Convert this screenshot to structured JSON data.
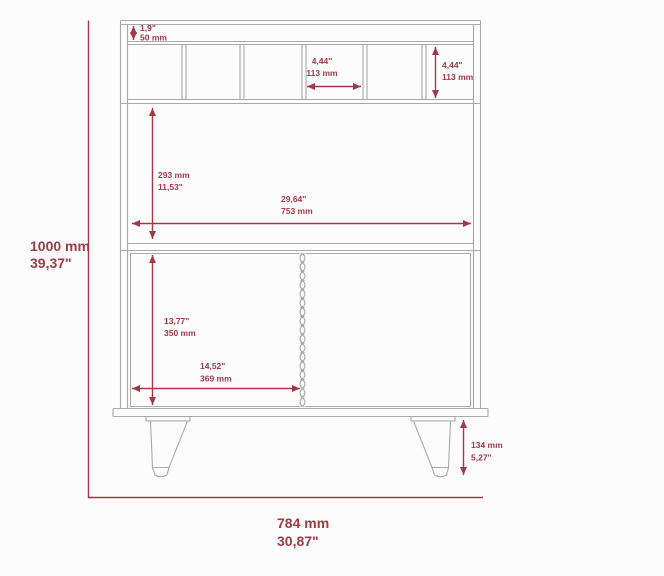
{
  "diagram": {
    "type": "furniture-dimension-drawing",
    "subject": "bar-cabinet-front-view",
    "labels": {
      "overall_height_mm": "1000 mm",
      "overall_height_in": "39,37\"",
      "overall_width_mm": "784 mm",
      "overall_width_in": "30,87\"",
      "top_gap_in": "1,9\"",
      "top_gap_mm": "50 mm",
      "slot_width_in": "4,44\"",
      "slot_width_mm": "113 mm",
      "slot_height_in": "4,44\"",
      "slot_height_mm": "113 mm",
      "shelf_height_mm": "293 mm",
      "shelf_height_in": "11,53\"",
      "shelf_width_in": "29,64\"",
      "shelf_width_mm": "753 mm",
      "door_height_in": "13,77\"",
      "door_height_mm": "350 mm",
      "door_width_in": "14,52\"",
      "door_width_mm": "369 mm",
      "leg_height_mm": "134 mm",
      "leg_height_in": "5,27\""
    },
    "colors": {
      "dimension_red": "#a23a46",
      "outline_gray": "#a9a9a9",
      "background": "#fcfcfc"
    }
  }
}
